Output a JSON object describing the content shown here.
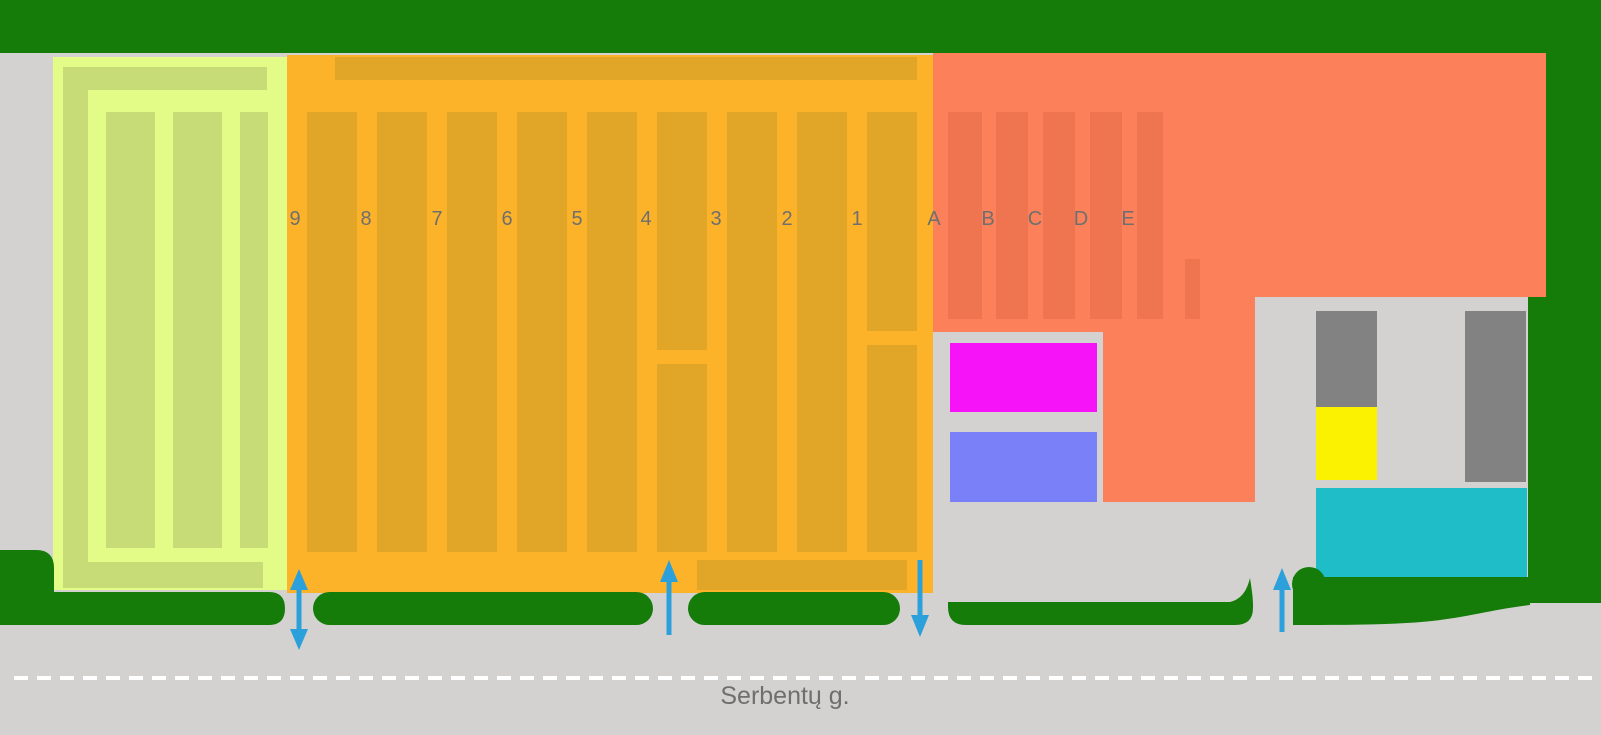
{
  "map": {
    "street_name": "Serbentų g.",
    "numeric_row_labels": [
      "9",
      "8",
      "7",
      "6",
      "5",
      "4",
      "3",
      "2",
      "1"
    ],
    "alpha_row_labels": [
      "A",
      "B",
      "C",
      "D",
      "E"
    ]
  },
  "colors": {
    "road": "#D3D2D0",
    "hedge_green": "#157C09",
    "lightgreen_zone": "#E3FB87",
    "lightgreen_stripe": "#C7DB76",
    "orange_zone": "#FCB32A",
    "orange_stripe": "#E1A528",
    "salmon_zone": "#FC815A",
    "salmon_stripe": "#EF7550",
    "building_magenta": "#F713F7",
    "building_periwinkle": "#7A80F8",
    "building_gray": "#828282",
    "building_yellow": "#FAF201",
    "building_teal": "#1EBDC8",
    "arrow_blue": "#2BA0DB",
    "lane_divider": "#FFFFFF",
    "label_text": "#6F6F6F"
  }
}
